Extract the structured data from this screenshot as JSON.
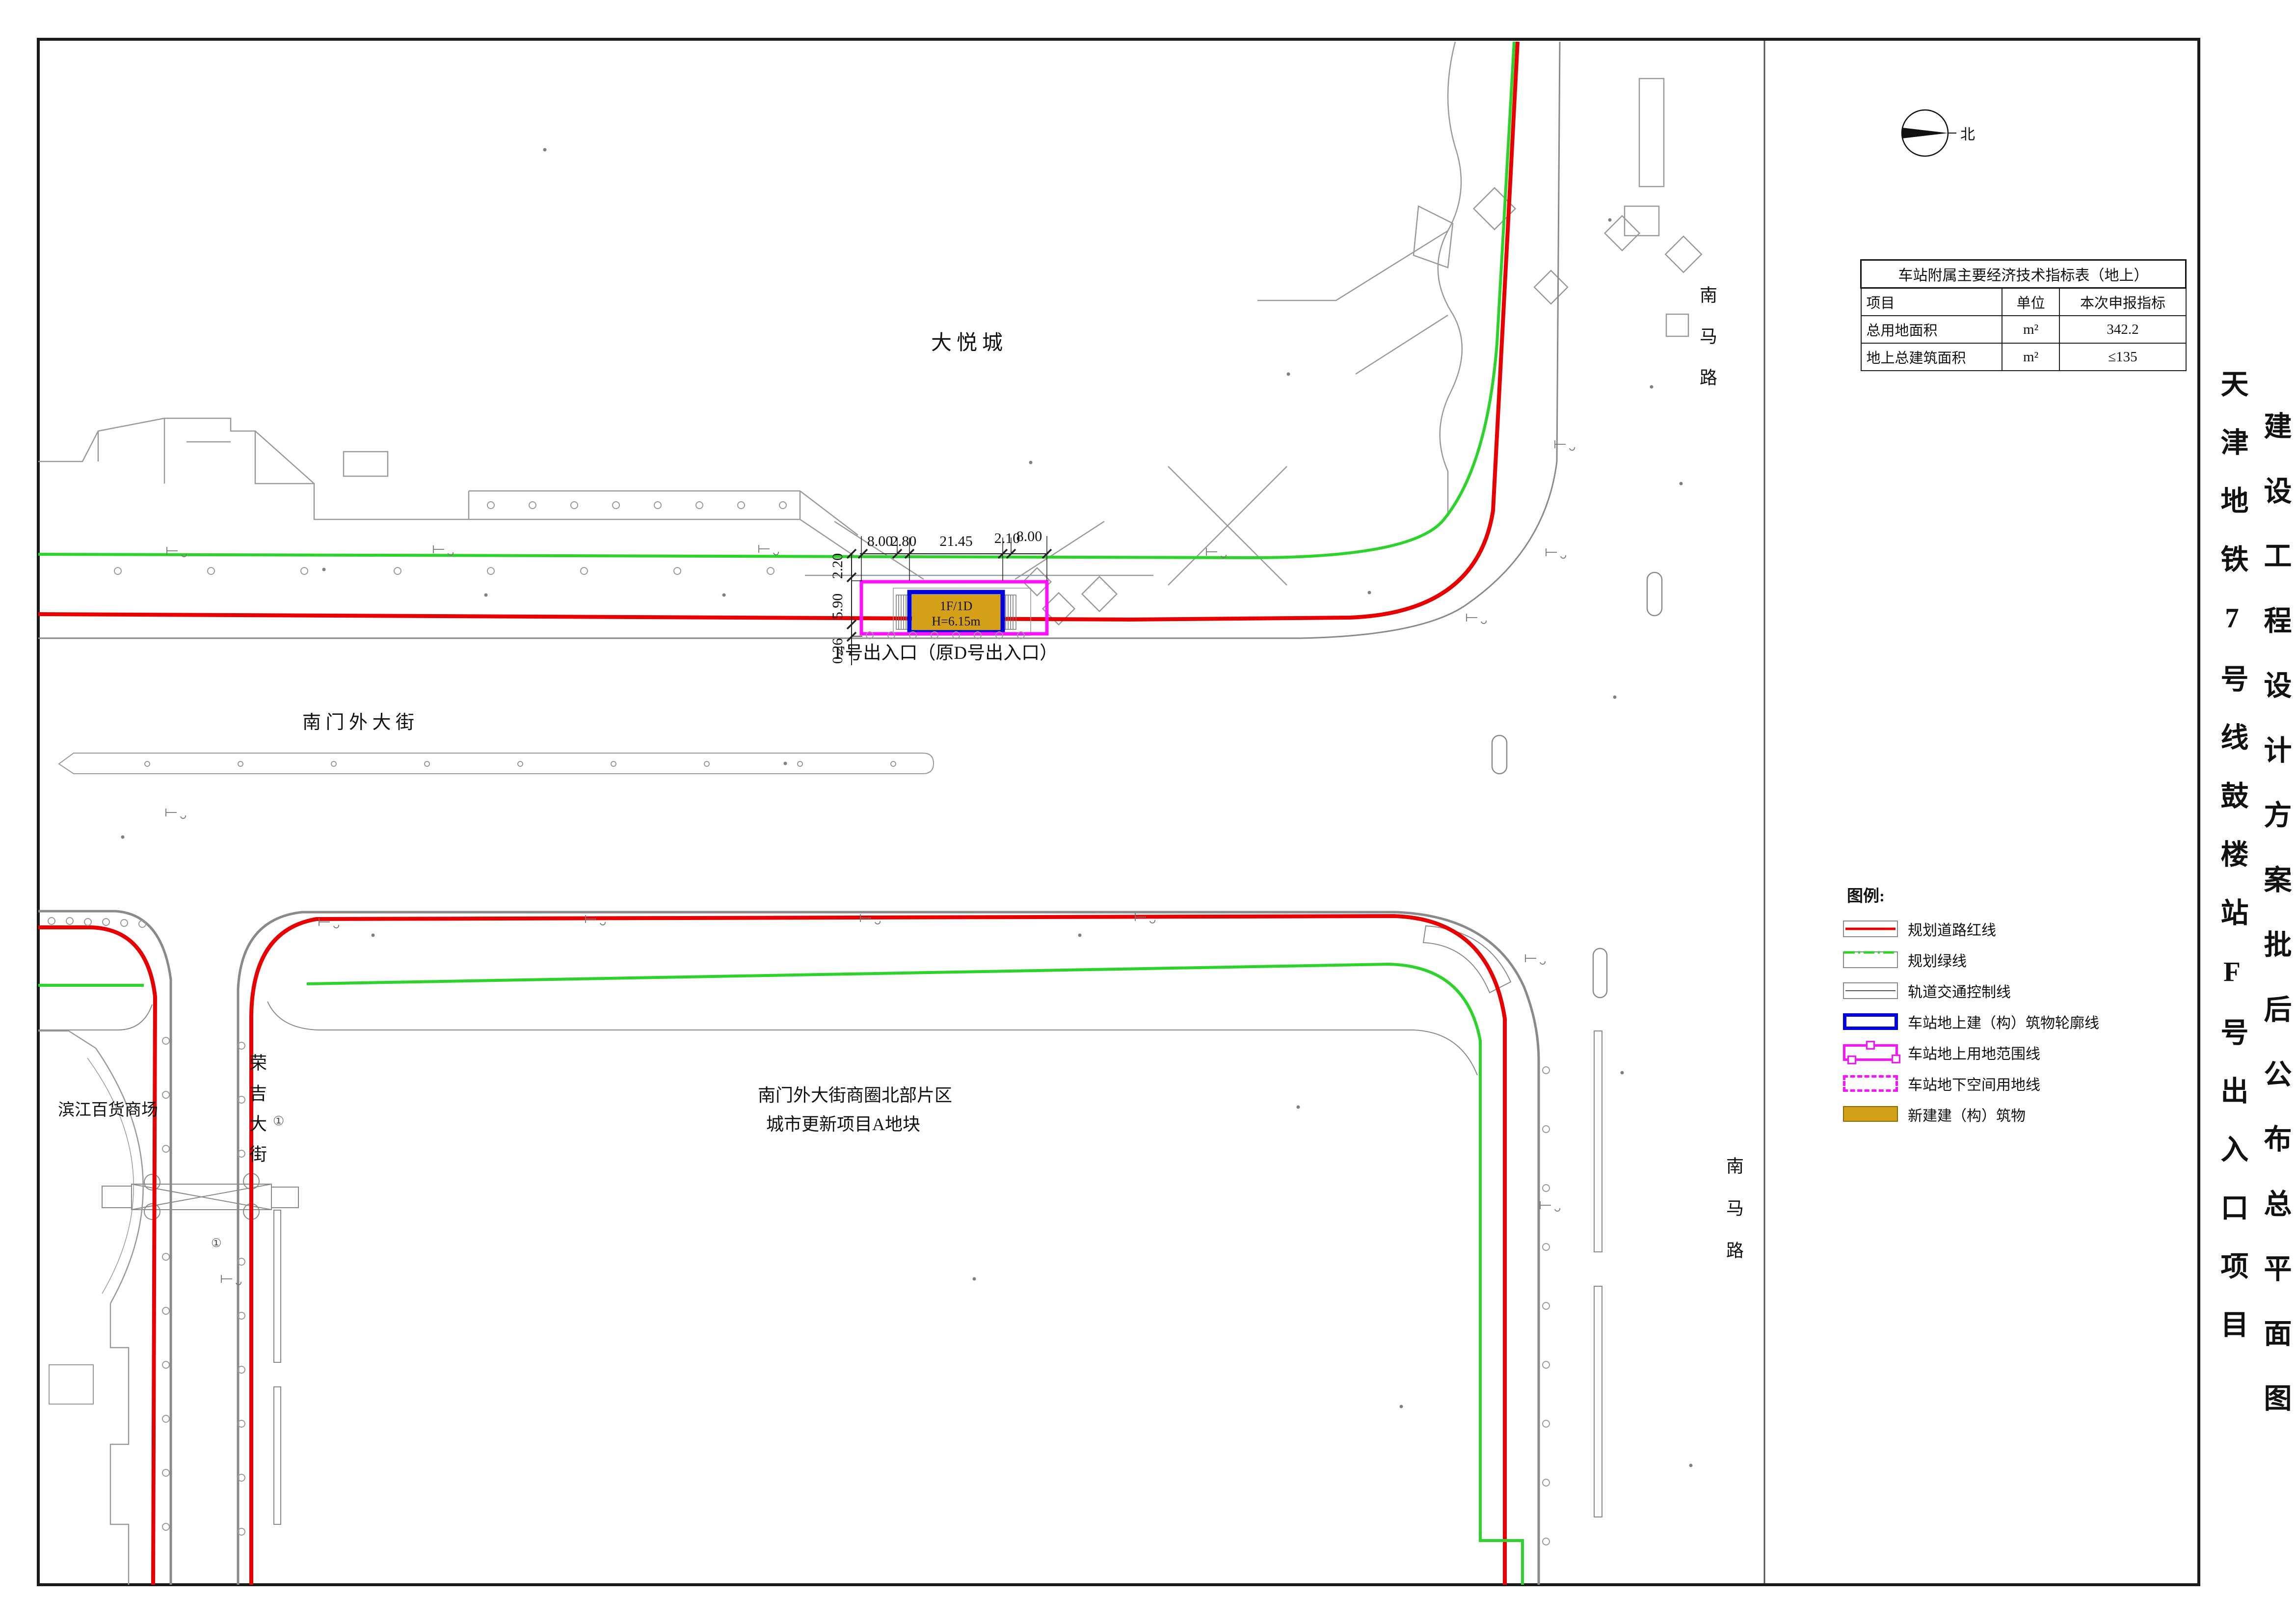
{
  "colors": {
    "road_red_line": "#e80000",
    "green_line": "#2bd32b",
    "magenta_line": "#ff10ff",
    "blue_outline": "#0000dd",
    "new_building_gold": "#d4a017",
    "road_gray": "#8a8a8a"
  },
  "titles": {
    "project": "天津地铁7号线鼓楼站F号出入口项目",
    "drawing": "建设工程设计方案批后公布总平面图"
  },
  "north": {
    "label": "北"
  },
  "table": {
    "title": "车站附属主要经济技术指标表（地上）",
    "headers": [
      "项目",
      "单位",
      "本次申报指标"
    ],
    "rows": [
      [
        "总用地面积",
        "m²",
        "342.2"
      ],
      [
        "地上总建筑面积",
        "m²",
        "≤135"
      ]
    ]
  },
  "legend": {
    "title": "图例:",
    "items": [
      {
        "symbol": "red-line",
        "label": "规划道路红线"
      },
      {
        "symbol": "green-dash-line",
        "label": "规划绿线"
      },
      {
        "symbol": "control-line",
        "label": "轨道交通控制线"
      },
      {
        "symbol": "blue-rect",
        "label": "车站地上建（构）筑物轮廓线"
      },
      {
        "symbol": "magenta-rect",
        "label": "车站地上用地范围线"
      },
      {
        "symbol": "magenta-dash-rect",
        "label": "车站地下空间用地线"
      },
      {
        "symbol": "gold-fill",
        "label": "新建建（构）筑物"
      }
    ]
  },
  "map_labels": {
    "mall": "大悦城",
    "nanmalu_top": "南马路",
    "nanmalu_bottom": "南马路",
    "nanmenwai_street": "南 门 外 大 街",
    "rongji_street": "荣吉大街",
    "binjiang": "滨江百货商场",
    "block_line1": "南门外大街商圈北部片区",
    "block_line2": "城市更新项目A地块",
    "entrance": "F号出入口（原D号出入口）",
    "entrance_tag_line1": "1F/1D",
    "entrance_tag_line2": "H=6.15m",
    "marker_a": "①",
    "marker_b": "①"
  },
  "dimensions": {
    "horizontal": [
      "8.00",
      "2.80",
      "21.45",
      "2.10",
      "8.00"
    ],
    "vertical": [
      "2.20",
      "5.90",
      "0.26"
    ]
  }
}
